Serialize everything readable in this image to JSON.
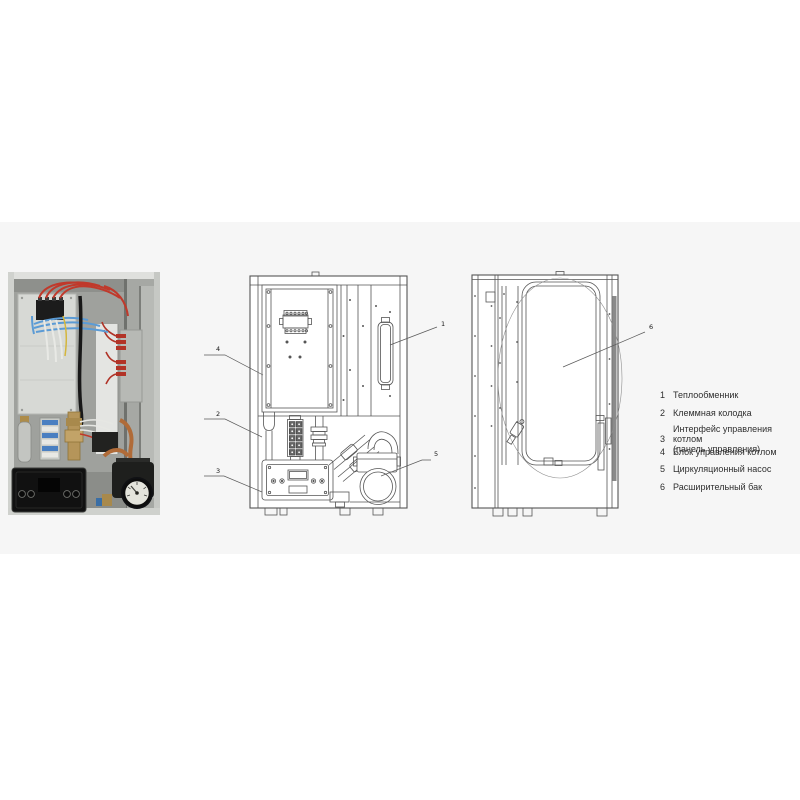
{
  "figure": {
    "background": "#ffffff",
    "band_color": "#f6f6f6",
    "drawing_stroke_color": "#555555"
  },
  "photo": {
    "colors": {
      "red_wire": "#c0392b",
      "blue_wire": "#5b9bd5",
      "white_wire": "#e8e9e5",
      "yellow_wire": "#d4b63c",
      "copper_pipe": "#b06b38",
      "brass_fitting": "#b5955a",
      "panel_black": "#131313",
      "cabinet_gray": "#b9bbb7"
    }
  },
  "callouts": {
    "heat_exchanger": "1",
    "terminal_block": "2",
    "control_interface": "3",
    "control_unit": "4",
    "pump": "5",
    "expansion_tank": "6"
  },
  "legend": {
    "items": [
      {
        "num": "1",
        "lines": [
          "Теплообменник"
        ]
      },
      {
        "num": "2",
        "lines": [
          "Клеммная колодка"
        ]
      },
      {
        "num": "3",
        "lines": [
          "Интерфейс управления котлом",
          "(панель управления)"
        ]
      },
      {
        "num": "4",
        "lines": [
          "Блок управления котлом"
        ]
      },
      {
        "num": "5",
        "lines": [
          "Циркуляционный насос"
        ]
      },
      {
        "num": "6",
        "lines": [
          "Расширительный бак"
        ]
      }
    ]
  }
}
